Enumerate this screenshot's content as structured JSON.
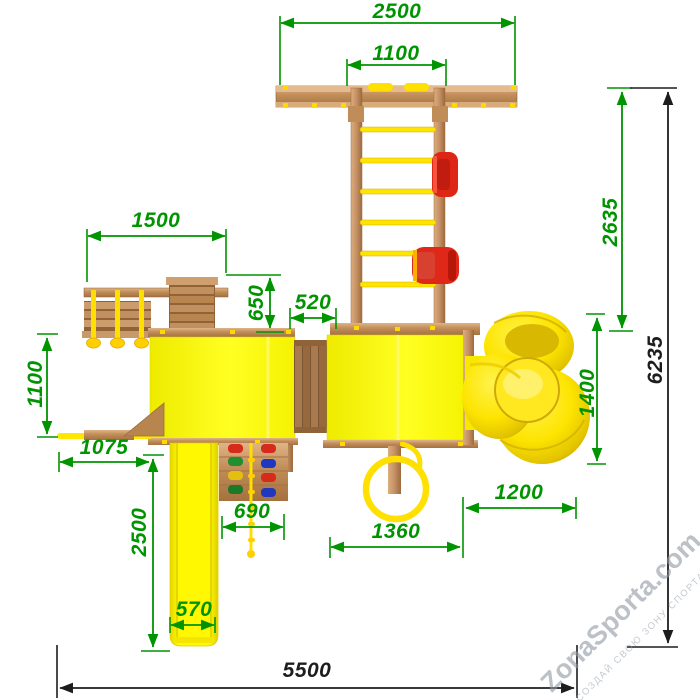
{
  "drawing": {
    "kind": "playground top-view dimensioned drawing",
    "units_hint": "mm"
  },
  "dimensions": {
    "top_beam_width": "2500",
    "ladder_span": "1100",
    "left_module_width": "1500",
    "left_module_depth": "650",
    "bridge_width": "520",
    "upper_section_depth": "2635",
    "total_depth": "6235",
    "spiral_slide_depth": "1400",
    "left_slide_depth": "1100",
    "left_slide_length": "1075",
    "main_slide_length": "2500",
    "main_slide_width": "570",
    "climb_wall_width": "690",
    "ring_module_width": "1360",
    "spiral_slide_width": "1200",
    "total_width": "5500"
  },
  "watermark": {
    "brand": "ZonaSporta.com",
    "slogan": "СОЗДАЙ СВОЮ ЗОНУ СПОРТА"
  },
  "colors": {
    "dimension_green": "#009400",
    "dimension_black": "#1d1d1d",
    "structure_yellow": "#fff000",
    "wood_light": "#d3a475",
    "wood_dark": "#a5713f",
    "accent_red": "#dd2818",
    "hold_blue": "#2038c0",
    "hold_green": "#1f8f2f"
  }
}
